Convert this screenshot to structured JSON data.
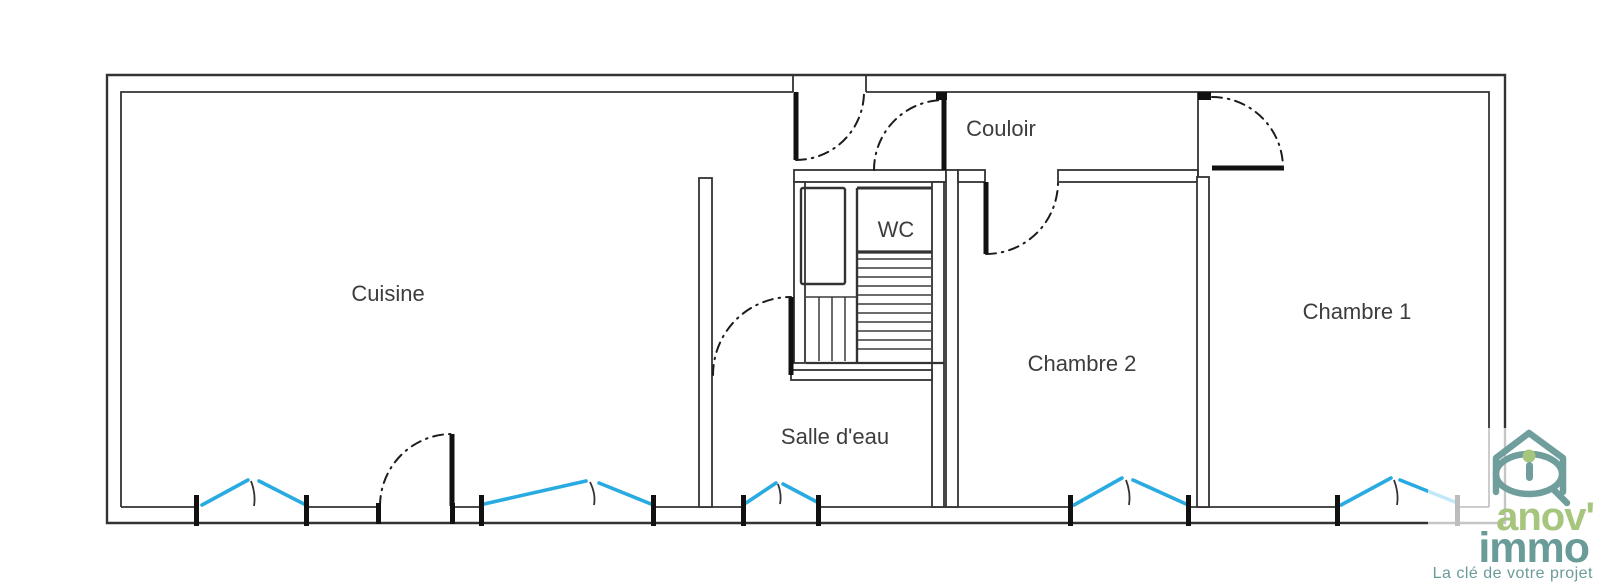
{
  "canvas": {
    "width": 1600,
    "height": 586,
    "background": "#ffffff"
  },
  "palette": {
    "wall": "#333333",
    "door": "#111111",
    "window_blue": "#29abe2",
    "label": "#3d3d3d",
    "logo_green": "#a6c57d",
    "logo_teal": "#699b98"
  },
  "rooms": [
    {
      "name": "cuisine",
      "label": "Cuisine"
    },
    {
      "name": "couloir",
      "label": "Couloir"
    },
    {
      "name": "wc",
      "label": "WC"
    },
    {
      "name": "salle-deau",
      "label": "Salle d'eau"
    },
    {
      "name": "chambre-2",
      "label": "Chambre 2"
    },
    {
      "name": "chambre-1",
      "label": "Chambre 1"
    }
  ],
  "features": {
    "doors": [
      "entrance-door",
      "couloir-door",
      "chambre-2-door",
      "chambre-1-door",
      "salle-deau-door",
      "cuisine-exterior-door"
    ],
    "windows": [
      "cuisine-window-1",
      "cuisine-window-2",
      "salle-deau-window",
      "chambre-2-window",
      "chambre-1-window"
    ],
    "stairs": "staircase"
  },
  "logo": {
    "brand_line1": "anov'",
    "brand_line2": "immo",
    "tagline": "La clé de votre projet"
  }
}
